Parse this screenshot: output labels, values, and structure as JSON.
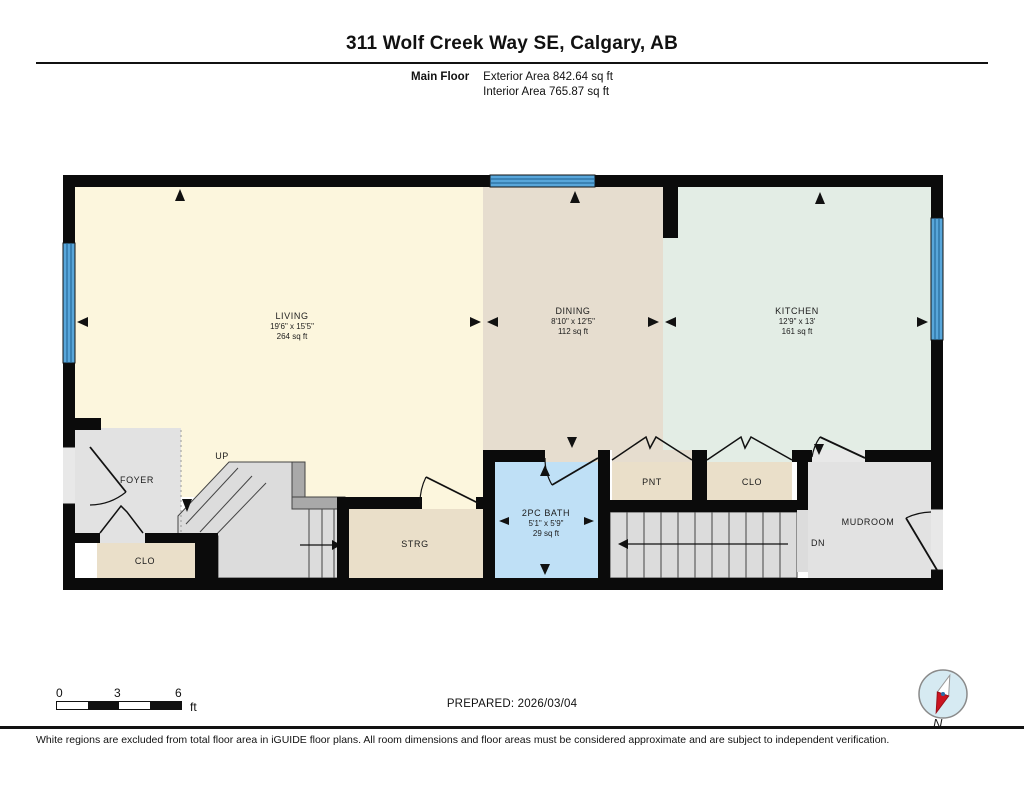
{
  "header": {
    "title": "311 Wolf Creek Way SE, Calgary, AB",
    "floor_label": "Main Floor",
    "exterior_area": "Exterior Area 842.64 sq ft",
    "interior_area": "Interior Area 765.87 sq ft"
  },
  "rooms": {
    "living": {
      "name": "LIVING",
      "dims": "19'6\" x 15'5\"",
      "area": "264 sq ft"
    },
    "dining": {
      "name": "DINING",
      "dims": "8'10\" x 12'5\"",
      "area": "112 sq ft"
    },
    "kitchen": {
      "name": "KITCHEN",
      "dims": "12'9\" x 13'",
      "area": "161 sq ft"
    },
    "bath": {
      "name": "2PC BATH",
      "dims": "5'1\" x 5'9\"",
      "area": "29 sq ft"
    },
    "foyer": {
      "name": "FOYER"
    },
    "closet_foyer": {
      "name": "CLO"
    },
    "storage": {
      "name": "STRG"
    },
    "pantry": {
      "name": "PNT"
    },
    "closet_kitchen": {
      "name": "CLO"
    },
    "mudroom": {
      "name": "MUDROOM"
    }
  },
  "stairs": {
    "up": "UP",
    "down": "DN"
  },
  "scale_bar": {
    "tick_0": "0",
    "tick_3": "3",
    "tick_6": "6",
    "unit": "ft"
  },
  "footer": {
    "prepared": "PREPARED: 2026/03/04",
    "compass_label": "N",
    "disclaimer": "White regions are excluded from total floor area in iGUIDE floor plans. All room dimensions and floor areas must be considered approximate and are subject to independent verification."
  },
  "colors": {
    "wall": "#0b0b0b",
    "living": "#fcf6dd",
    "dining": "#e6ddcf",
    "kitchen": "#e3ede5",
    "closet": "#eadfc9",
    "bath": "#bfe0f6",
    "gray_room": "#e2e2e2",
    "stair": "#dcdcdc",
    "railing": "#a9a9a9",
    "window": "#58a6da",
    "window_line": "#1d5e8d",
    "compass_fill": "#d6eaf2",
    "compass_red": "#cc1420"
  }
}
